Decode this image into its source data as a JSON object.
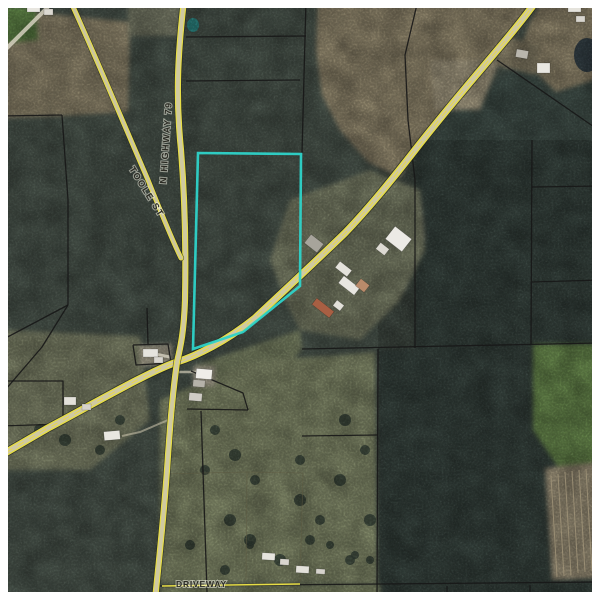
{
  "map": {
    "description": "Aerial GIS parcel map with highlighted parcel",
    "labels": {
      "highway79": "N HIGHWAY 79",
      "toole": "TOOLE ST",
      "driveway": "DRIVEWAY"
    },
    "colors": {
      "frame": "#FFFFFF",
      "parcel_highlight": "#2ED3C9",
      "road_yellow": "#E6DD46",
      "parcel_line": "#171717",
      "forest_base": "#57645A",
      "pine_plantation": "#4C5B55"
    },
    "selected_parcel": {
      "points": "198,153 301,154 300,286 243,332 193,349",
      "color": "#2ED3C9"
    },
    "geometry": {
      "roads": {
        "highway_curve": "M537,0 C510,38 468,82 415,150 C398,172 372,205 345,233 C315,262 285,290 255,318 C225,342 196,356 177,362 C150,371 95,403 48,428 L0,456",
        "highway79": "M184,0 C177,60 176,100 181,150 C185,200 186,250 185,300 C184,330 181,345 177,362 C171,405 170,430 168,455 C165,505 160,550 155,600",
        "toole": "M70,0 C95,55 120,115 148,180 C160,210 172,240 181,258",
        "driveway": "M162,586 L300,584"
      },
      "pine_blocks": [
        "415,140 600,140 600,600 378,600 378,350 415,348",
        "520,60 600,80 600,140 415,140"
      ],
      "fields": [
        {
          "p": "30,12 130,22 128,112 60,116 0,118 0,40",
          "f": "#a89d7f"
        },
        {
          "p": "0,6 36,8 38,40 0,44",
          "f": "#6f9c52"
        },
        {
          "p": "128,0 180,0 180,36 128,36",
          "f": "#8b8f78"
        },
        {
          "p": "318,0 537,0 510,38 468,82 415,150 400,178 368,162 340,130 322,95 316,50",
          "f": "#ab9f80"
        },
        {
          "p": "430,60 500,60 480,110 435,110",
          "f": "#bdb295"
        },
        {
          "p": "543,0 600,0 600,78 556,92 518,55 530,22",
          "f": "#a89c7e"
        },
        {
          "p": "500,35 540,45 535,75 495,65",
          "f": "#9a9176"
        },
        {
          "p": "365,185 420,190 425,240 400,262 372,230",
          "f": "#cfc7b0"
        },
        {
          "p": "290,200 370,170 420,190 425,250 400,300 360,340 300,330 285,300 270,260",
          "f": "#8d9377"
        },
        {
          "p": "0,330 140,336 150,420 90,470 0,470",
          "f": "#93997a"
        },
        {
          "p": "195,365 300,330 302,349 250,410 200,410",
          "f": "#95a07a"
        },
        {
          "p": "160,400 230,370 260,360 330,356 375,352 377,583 160,583",
          "f": "#99a27c"
        },
        {
          "p": "533,344 600,344 600,470 560,470 533,430",
          "f": "#7aa05a"
        },
        {
          "p": "545,468 600,462 600,578 552,580",
          "f": "#b2a68a"
        },
        {
          "p": "160,586 380,584 380,600 160,600",
          "f": "#8f9973"
        },
        {
          "p": "140,345 172,344 172,366 140,366",
          "f": "#c6bfa8"
        },
        {
          "p": "193,366 215,366 215,386 193,386",
          "f": "#c9c2ac"
        }
      ],
      "parcel_lines": [
        "186,37 306,36",
        "186,81 300,80",
        "306,0 302,153",
        "0,116 62,115",
        "62,115 68,200 68,305",
        "68,305 0,341",
        "68,305 42,347 0,396",
        "147,308 148,344",
        "133,345 168,344 171,363 136,365 133,345",
        "0,381 63,381 63,424 0,426",
        "191,371 243,393 248,410",
        "187,409 248,410",
        "201,411 207,592",
        "302,349 600,343",
        "378,349 377,600",
        "302,436 378,435",
        "532,140 531,344",
        "532,187 600,186",
        "532,282 600,280",
        "418,0 405,55 408,120 415,180 415,348",
        "497,60 600,131",
        "530,585 530,600",
        "447,586 447,600",
        "160,586 600,582"
      ],
      "fences": [
        "247,472 303,473",
        "303,473 300,582",
        "247,472 246,580",
        "160,474 247,472"
      ],
      "furrows": [
        "551,476 557,577",
        "558,474 564,576",
        "565,472 571,575",
        "572,471 578,573",
        "579,470 585,572",
        "586,469 592,571",
        "593,468 598,570"
      ],
      "light_paths": [
        {
          "p": "48,7 0,55",
          "w": 4,
          "c": "#d6d1c0",
          "o": 0.85
        },
        {
          "p": "145,352 170,357",
          "w": 3,
          "c": "#d6d1c0",
          "o": 0.8
        },
        {
          "p": "176,372 196,372",
          "w": 2.5,
          "c": "#cfc9b4",
          "o": 0.7
        },
        {
          "p": "168,420 140,432 122,436",
          "w": 2,
          "c": "#c6bfa8",
          "o": 0.6
        }
      ],
      "ponds": [
        {
          "cx": 587,
          "cy": 55,
          "rx": 13,
          "ry": 17,
          "f": "#3d4b52"
        },
        {
          "cx": 193,
          "cy": 25,
          "rx": 6,
          "ry": 7,
          "f": "#37a8a4"
        }
      ],
      "trees": [
        [
          215,
          430,
          5
        ],
        [
          235,
          455,
          6
        ],
        [
          255,
          480,
          5
        ],
        [
          300,
          500,
          6
        ],
        [
          320,
          520,
          5
        ],
        [
          340,
          480,
          6
        ],
        [
          310,
          540,
          5
        ],
        [
          280,
          560,
          6
        ],
        [
          350,
          560,
          5
        ],
        [
          230,
          520,
          6
        ],
        [
          205,
          470,
          5
        ],
        [
          365,
          450,
          5
        ],
        [
          345,
          420,
          6
        ],
        [
          300,
          460,
          5
        ],
        [
          250,
          540,
          6
        ],
        [
          225,
          570,
          5
        ],
        [
          190,
          545,
          5
        ],
        [
          370,
          520,
          6
        ],
        [
          65,
          440,
          6
        ],
        [
          100,
          450,
          5
        ],
        [
          120,
          420,
          5
        ],
        [
          40,
          430,
          6
        ],
        [
          250,
          545,
          4
        ],
        [
          330,
          545,
          4
        ],
        [
          355,
          555,
          4
        ],
        [
          370,
          560,
          4
        ]
      ],
      "buildings": [
        [
          27,
          4,
          13,
          8,
          0,
          "#e8e6e0"
        ],
        [
          44,
          9,
          9,
          6,
          0,
          "#dcd9d2"
        ],
        [
          568,
          4,
          13,
          8,
          0,
          "#e5e3dc"
        ],
        [
          576,
          16,
          9,
          6,
          0,
          "#d8d5ce"
        ],
        [
          516,
          50,
          12,
          8,
          10,
          "#b9b6ad"
        ],
        [
          537,
          63,
          13,
          10,
          0,
          "#e9e7e1"
        ],
        [
          306,
          238,
          16,
          11,
          38,
          "#a7a49b"
        ],
        [
          388,
          231,
          21,
          16,
          38,
          "#eceae5"
        ],
        [
          377,
          245,
          11,
          8,
          38,
          "#dddad2"
        ],
        [
          336,
          265,
          15,
          8,
          38,
          "#e4e2db"
        ],
        [
          339,
          281,
          20,
          9,
          38,
          "#e8e6e0"
        ],
        [
          357,
          281,
          11,
          9,
          38,
          "#b98a6a"
        ],
        [
          312,
          304,
          22,
          8,
          38,
          "#a85f43"
        ],
        [
          334,
          302,
          9,
          7,
          38,
          "#e2e0d9"
        ],
        [
          143,
          349,
          15,
          8,
          0,
          "#e6e4de"
        ],
        [
          154,
          357,
          9,
          6,
          0,
          "#d9d6cf"
        ],
        [
          196,
          369,
          16,
          10,
          5,
          "#efede8"
        ],
        [
          193,
          380,
          12,
          7,
          5,
          "#b5b2a9"
        ],
        [
          189,
          393,
          13,
          8,
          5,
          "#cfccc5"
        ],
        [
          64,
          397,
          12,
          8,
          0,
          "#e3e1da"
        ],
        [
          82,
          404,
          9,
          6,
          0,
          "#d6d3cc"
        ],
        [
          104,
          431,
          16,
          9,
          -5,
          "#e8e6e0"
        ],
        [
          262,
          553,
          13,
          7,
          3,
          "#e6e4de"
        ],
        [
          280,
          559,
          9,
          6,
          3,
          "#d9d6cf"
        ],
        [
          296,
          566,
          13,
          7,
          3,
          "#e3e1da"
        ],
        [
          316,
          569,
          9,
          5,
          3,
          "#d6d3cc"
        ]
      ]
    }
  }
}
